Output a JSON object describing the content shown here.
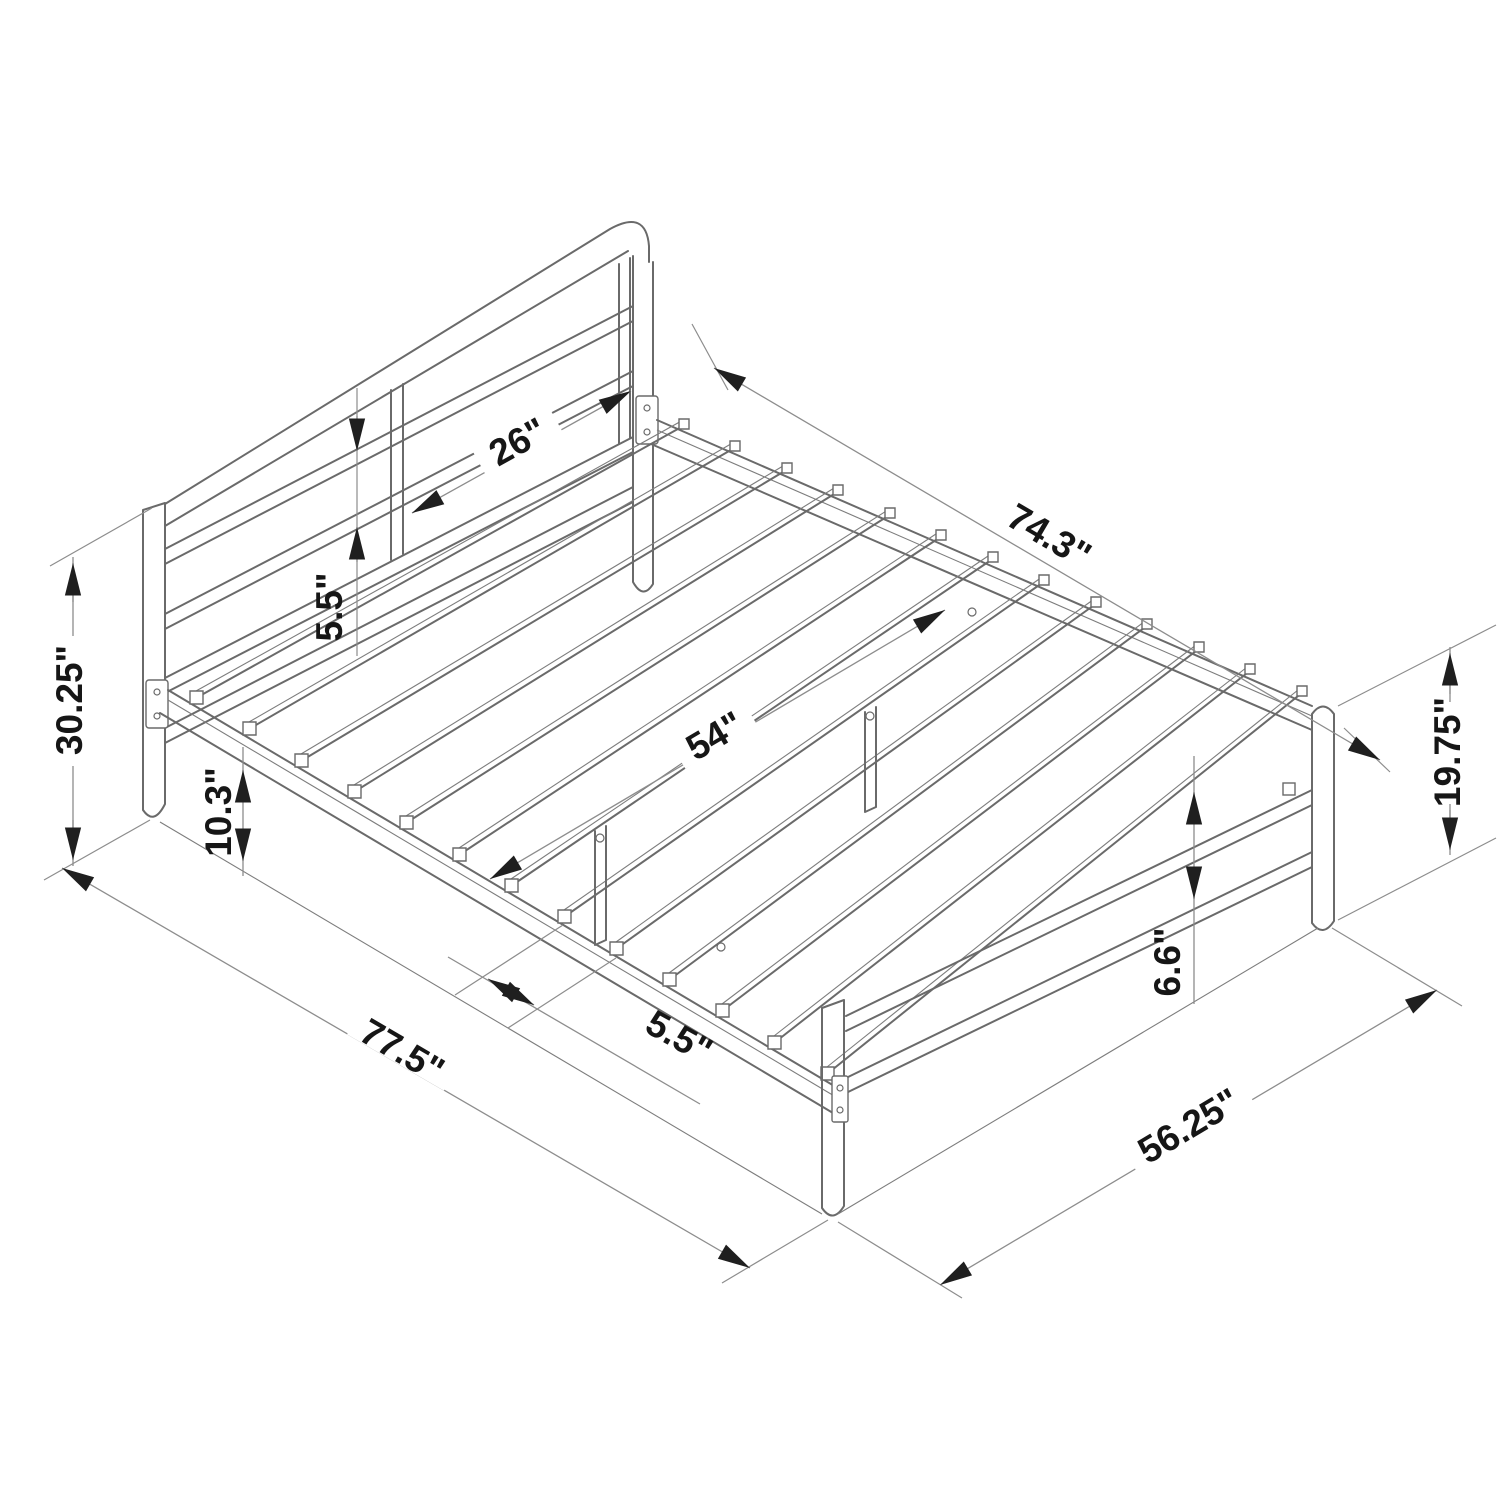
{
  "diagram": {
    "subject": "metal-bed-frame-dimension-drawing",
    "view": "isometric line drawing",
    "units": "inches",
    "background_color": "#ffffff",
    "line_color": "#6a6a6a",
    "dimension_line_color": "#8d8d8d",
    "text_color": "#161616",
    "dimensions": {
      "headboard_panel_width": "26\"",
      "frame_inner_length": "74.3\"",
      "headboard_rail_gap": "5.5\"",
      "headboard_height": "30.25\"",
      "side_rail_clearance": "10.3\"",
      "slat_width": "54\"",
      "footboard_post_height": "19.75\"",
      "foot_rail_height": "6.6\"",
      "slat_spacing": "5.5\"",
      "overall_length": "77.5\"",
      "overall_width": "56.25\""
    }
  }
}
